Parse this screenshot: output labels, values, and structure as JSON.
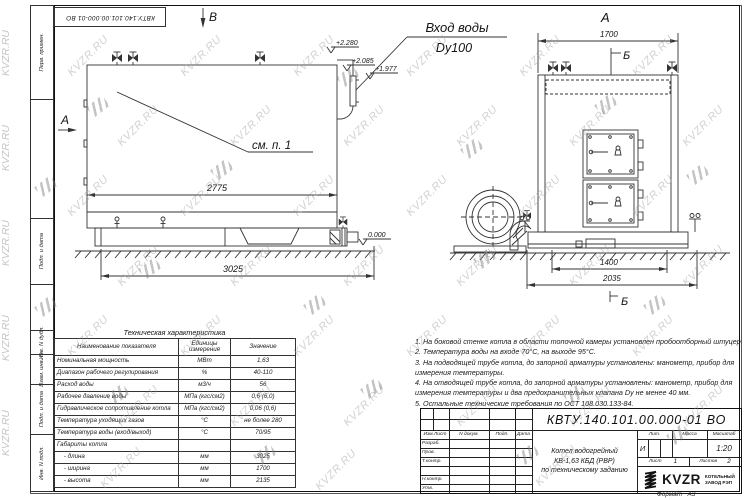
{
  "watermark": {
    "text": "KVZR.RU"
  },
  "frame": {
    "top_doc_number": "КВТУ.140.101.00.000-01 ВО",
    "margin_labels": [
      "Перв. примен.",
      "Подп. и дата",
      "Инв. N дубл.",
      "Взам. инв. N",
      "Подп. и дата",
      "Инв. N подл."
    ]
  },
  "drawing": {
    "left_view": {
      "marker_top": "В",
      "marker_side": "А",
      "inlet_line1": "Вход воды",
      "inlet_line2": "Dy100",
      "callout": "см. п. 1",
      "elev_top": "+2.280",
      "elev_mid": "+2.085",
      "elev_low": "+1.977",
      "elev_zero": "0.000",
      "dim_inner": "2775",
      "dim_overall": "3025"
    },
    "right_view": {
      "view_label": "А",
      "section_top": "Б",
      "section_bottom": "Б",
      "dim_width": "1700",
      "dim_base_inner": "1400",
      "dim_base_overall": "2035"
    }
  },
  "table": {
    "title": "Техническая характеристика",
    "headers": [
      "Наименование показателя",
      "Единицы измерения",
      "Значение"
    ],
    "rows": [
      [
        "Номинальная мощность",
        "МВт",
        "1,63"
      ],
      [
        "Диапазон рабочего регулирования",
        "%",
        "40-110"
      ],
      [
        "Расход воды",
        "м3/ч",
        "56"
      ],
      [
        "Рабочее давление воды",
        "МПа (кгс/см2)",
        "0,6 (6,0)"
      ],
      [
        "Гидравлическое сопротивление котла",
        "МПа (кгс/см2)",
        "0,06 (0,6)"
      ],
      [
        "Температура уходящих газов",
        "°С",
        "не более 280"
      ],
      [
        "Температура воды (вход/выход)",
        "°С",
        "70/95"
      ],
      [
        "Габариты котла",
        "",
        ""
      ],
      [
        "    - длина",
        "мм",
        "3025"
      ],
      [
        "    - ширина",
        "мм",
        "1700"
      ],
      [
        "    - высота",
        "мм",
        "2135"
      ]
    ]
  },
  "notes": [
    "1. На боковой стенке котла в области топочной камеры установлен пробоотборный штуцер",
    "2. Температура воды на входе 70°С, на выходе 95°С.",
    "3. На подводящей трубе котла, до запорной арматуры установлены: манометр, прибор для измерения температуры.",
    "4. На отводящей трубе котла, до запорной арматуры установлены: манометр, прибор для измерения температуры и два предохранительных клапана Dу не менее 40 мм.",
    "5. Остальные технические требования по ОСТ 108.030.133-84."
  ],
  "stamp": {
    "doc_number": "КВТУ.140.101.00.000-01 ВО",
    "header_cols": [
      "Изм.Лист",
      "N докум.",
      "Подп.",
      "Дата"
    ],
    "row_labels": [
      "Разраб.",
      "Пров.",
      "Т.контр.",
      "",
      "Н.контр.",
      "Утв."
    ],
    "title_lines": [
      "Котел водогрейный",
      "КВ-1,63 КБД (РВР)",
      "по техническому заданию"
    ],
    "lit_label": "Лит.",
    "mass_label": "Масса",
    "scale_label": "Масштаб",
    "lit_value": "И",
    "scale_value": "1:20",
    "sheet_label": "Лист",
    "sheet_value": "1",
    "sheets_label": "Листов",
    "sheets_value": "2",
    "logo_text": "KVZR",
    "logo_sub1": "КОТЕЛЬНЫЙ",
    "logo_sub2": "ЗАВОД РЭП",
    "format_label": "Формат",
    "format_value": "А3"
  }
}
